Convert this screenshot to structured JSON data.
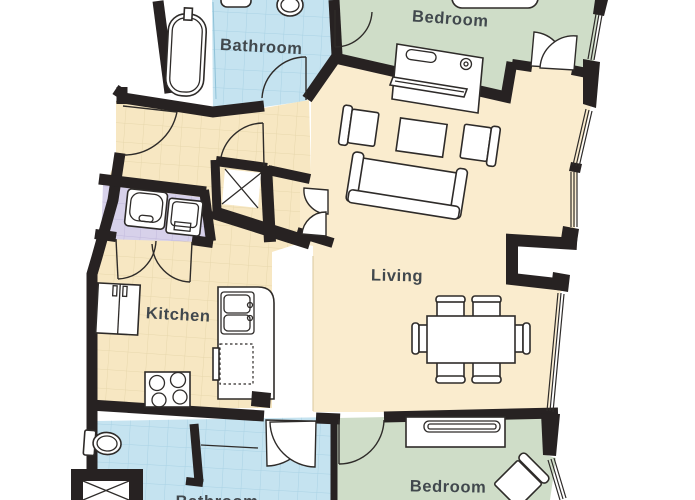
{
  "labels": {
    "bathroom_top": "Bathroom",
    "bedroom_top": "Bedroom",
    "living": "Living",
    "kitchen": "Kitchen",
    "bedroom_bottom": "Bedroom",
    "bathroom_bottom": "Bathroom"
  },
  "colors": {
    "wall": "#272222",
    "bathroom": "#C5E3F0",
    "bedroom": "#CFDDC8",
    "living": "#FAECCE",
    "kitchen": "#F7E7C2",
    "vanity": "#D7D1EA",
    "furniture_outline": "#2E2B29",
    "label": "#41484D",
    "floor_white": "#FFFFFF"
  }
}
